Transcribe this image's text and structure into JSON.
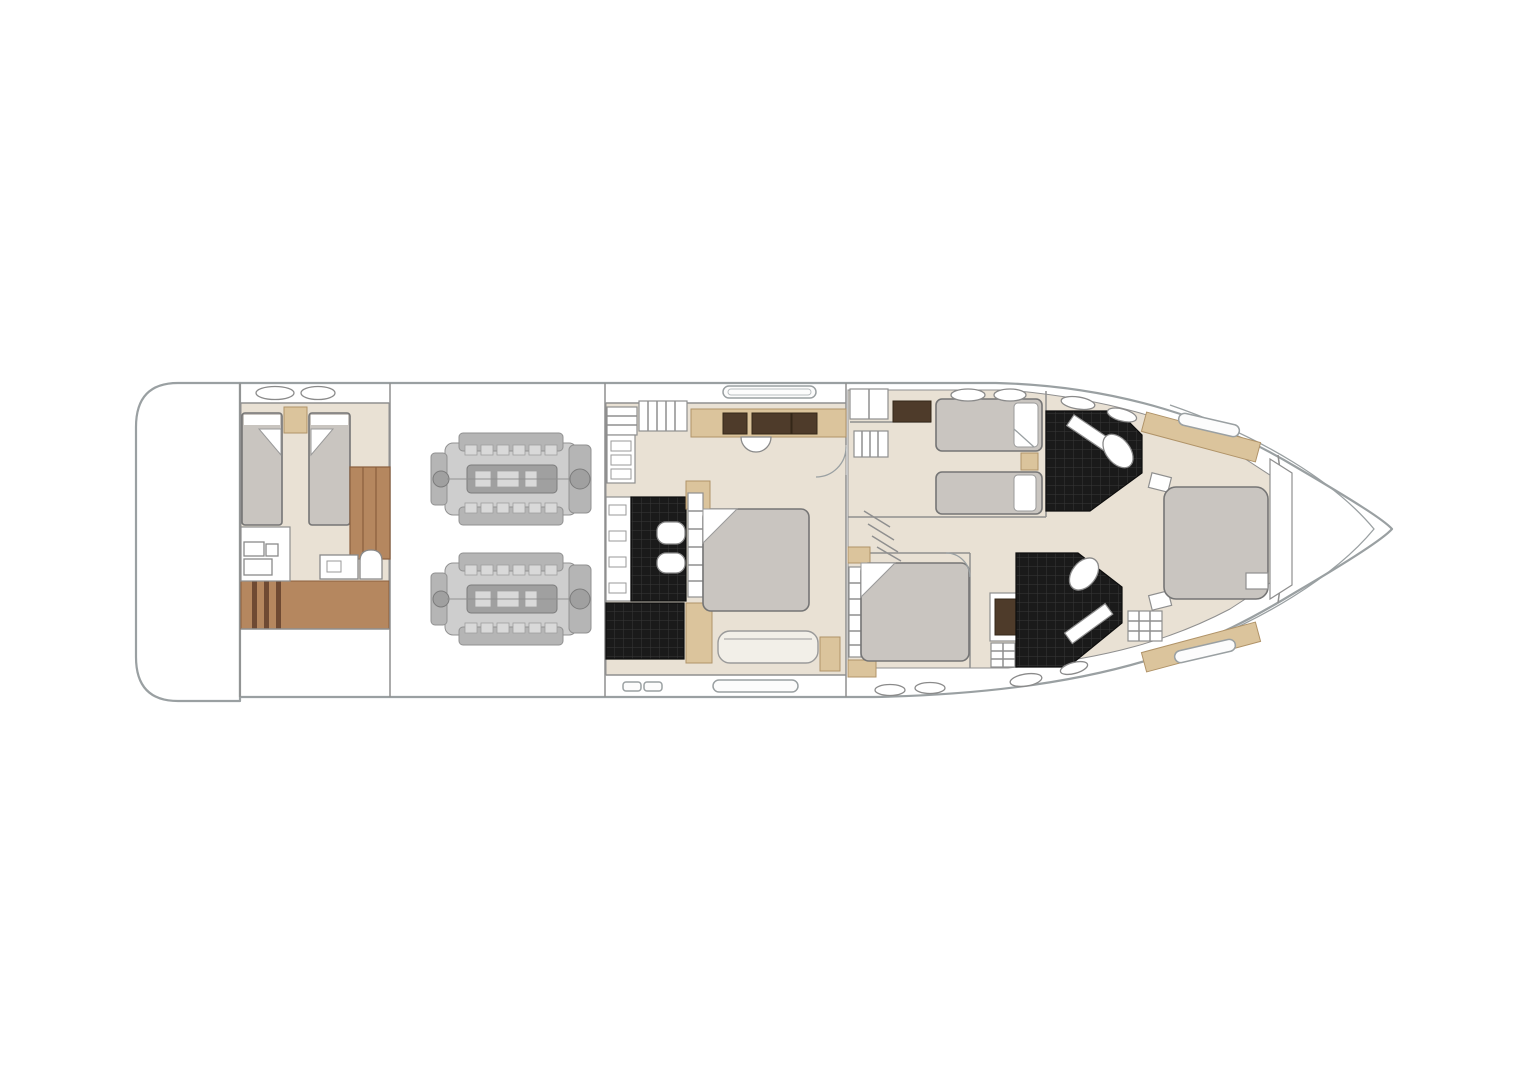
{
  "page": {
    "background": "#ffffff",
    "width": 1526,
    "height": 1080
  },
  "diagram": {
    "type": "yacht-deck-plan",
    "view": "top-down",
    "orientation": "bow-right",
    "rooms": [
      {
        "id": "swim-platform"
      },
      {
        "id": "crew-cabin",
        "single_berths": 2,
        "head_compartment": true,
        "wardrobe": true,
        "companionway_steps": true
      },
      {
        "id": "engine-room",
        "engines": 2
      },
      {
        "id": "midship-master-cabin",
        "double_bed": true,
        "sofa": true,
        "vanity_with_stool": true,
        "ensuite": {
          "sinks": 2,
          "shower": true,
          "finish": "black-tile"
        }
      },
      {
        "id": "guest-cabin-upper-twin",
        "single_berths": 2,
        "wardrobe": true
      },
      {
        "id": "guest-cabin-lower-double",
        "double_bed": true,
        "cabinet": true
      },
      {
        "id": "bathroom-upper-forward",
        "finish": "black-tile",
        "sink": true
      },
      {
        "id": "bathroom-lower-forward",
        "finish": "black-tile",
        "sink": true
      },
      {
        "id": "forward-vip-cabin",
        "double_bed": true,
        "hull_windows": 2
      }
    ],
    "deck_fittings": {
      "deck_hatches": 10,
      "hull_windows": 6
    }
  },
  "colors": {
    "outline": "#9aa0a2",
    "wall": "#8f8f8f",
    "floor": "#e9e1d4",
    "wood": "#b5875f",
    "woodDark": "#8a5f3e",
    "stepDark": "#6f4a33",
    "tan": "#dbc49c",
    "tanDark": "#b09368",
    "panelBrown": "#4e3b2a",
    "mattress": "#c9c5c0",
    "mattressEdge": "#757575",
    "tileBlack": "#1a1a1a",
    "tileLine": "#383838",
    "sofa": "#f2efe8",
    "engineLight": "#cccccc",
    "engineMid": "#b2b2b2",
    "engineDeep": "#9b9b9b",
    "engineDark": "#8c8c8c"
  }
}
